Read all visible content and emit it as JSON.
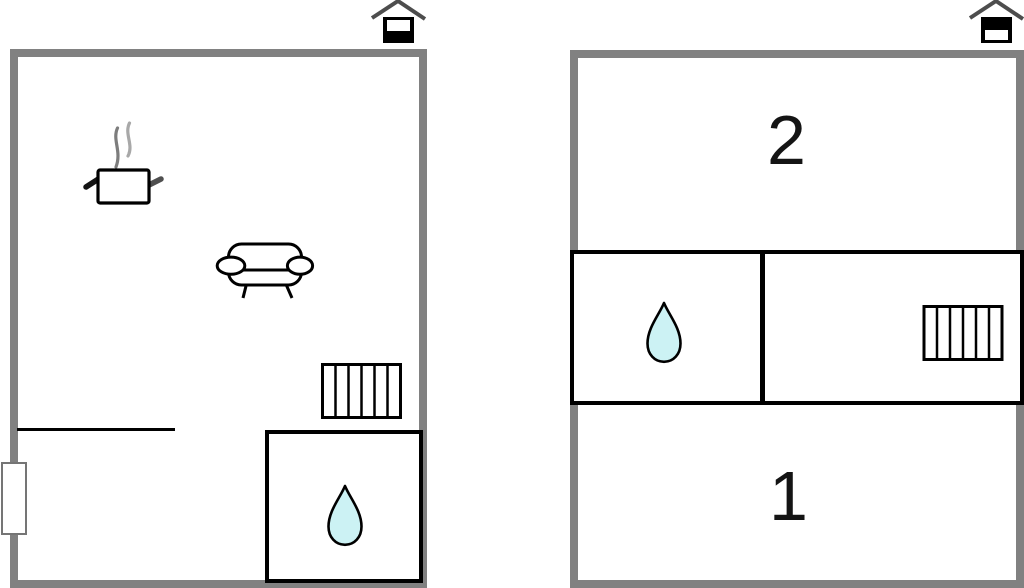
{
  "canvas": {
    "width": 1024,
    "height": 588,
    "background": "#ffffff"
  },
  "colors": {
    "wall_grey": "#818181",
    "interior_line": "#000000",
    "water_drop_fill": "#ccf2f4",
    "roof_grey": "#4d4d4d",
    "steam_dark": "#7d7d7d",
    "steam_light": "#a8a8a8",
    "window_border": "#757575"
  },
  "plans": [
    {
      "name": "floor-plan-left",
      "level_icon": {
        "name": "house-level-icon",
        "marked_section": "lower"
      },
      "rooms": [
        {
          "name": "main-room",
          "label": ""
        },
        {
          "name": "bathroom",
          "label": ""
        }
      ],
      "fixtures": [
        {
          "name": "cooking-pot-icon"
        },
        {
          "name": "sofa-icon"
        },
        {
          "name": "radiator-icon"
        },
        {
          "name": "water-drop-icon"
        },
        {
          "name": "window"
        }
      ]
    },
    {
      "name": "floor-plan-right",
      "level_icon": {
        "name": "house-level-icon",
        "marked_section": "upper"
      },
      "rooms": [
        {
          "name": "room-2",
          "label": "2"
        },
        {
          "name": "room-1",
          "label": "1"
        },
        {
          "name": "bathroom-band",
          "label": ""
        }
      ],
      "fixtures": [
        {
          "name": "water-drop-icon"
        },
        {
          "name": "radiator-icon"
        }
      ]
    }
  ]
}
